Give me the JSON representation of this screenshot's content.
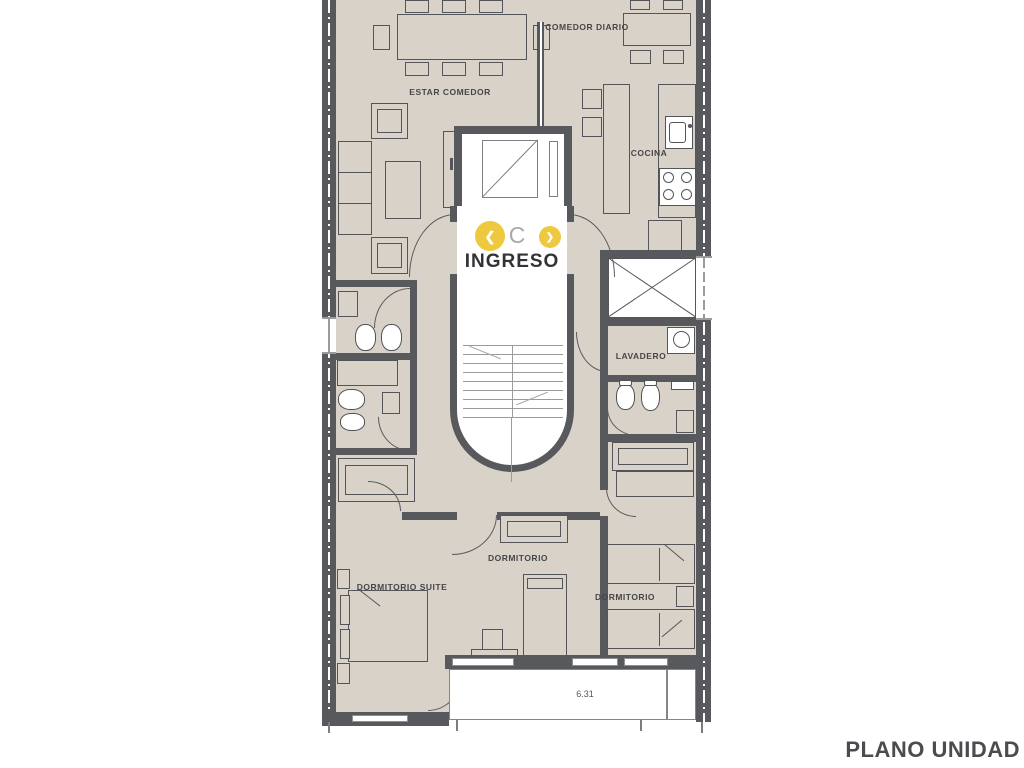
{
  "plan": {
    "rooms": {
      "estar_comedor": "ESTAR COMEDOR",
      "comedor_diario": "COMEDOR DIARIO",
      "cocina": "COCINA",
      "lavadero": "LAVADERO",
      "dormitorio_suite": "DORMITORIO SUITE",
      "dormitorio_center": "DORMITORIO",
      "dormitorio_right": "DORMITORIO"
    },
    "entrance": {
      "label": "INGRESO"
    },
    "dimensions": {
      "balcony_width_m": "6.31"
    },
    "title": "PLANO UNIDAD"
  },
  "overlay": {
    "prev_glyph": "❮",
    "center_glyph": "C",
    "next_glyph": "❯"
  },
  "colors": {
    "wall": "#58595c",
    "floor": "#d9d2c9",
    "accent_yellow": "#eec83e",
    "label_text": "#45464a"
  }
}
